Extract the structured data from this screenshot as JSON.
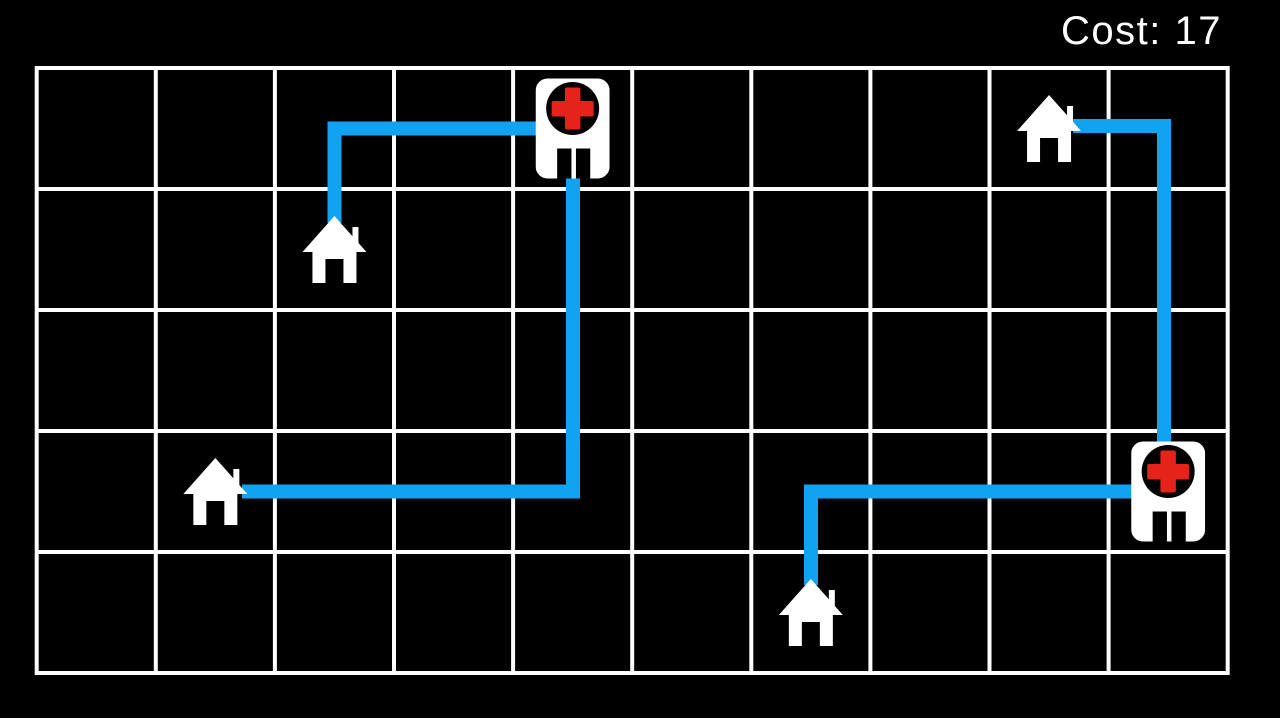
{
  "hud": {
    "cost_label": "Cost:",
    "cost_value": "17",
    "cost_text": "Cost: 17"
  },
  "colors": {
    "background": "#000000",
    "grid_line": "#ffffff",
    "route": "#11a2f2",
    "icon": "#ffffff",
    "icon_detail": "#000000",
    "cross_red": "#e4231a",
    "hud_text": "#ffffff"
  },
  "board": {
    "columns": 10,
    "rows": 5,
    "origin_x": 36.7,
    "origin_y": 68,
    "cell_width": 119.1,
    "cell_height": 121,
    "grid_line_width": 4
  },
  "icon_sizes": {
    "house": {
      "width": 64,
      "height": 67
    },
    "hospital": {
      "width": 74,
      "height": 100
    }
  },
  "entities": [
    {
      "id": "hospital-1",
      "type": "hospital",
      "icon": "hospital-icon",
      "col": 4,
      "row": 0
    },
    {
      "id": "hospital-2",
      "type": "hospital",
      "icon": "hospital-icon",
      "col": 9,
      "row": 3
    },
    {
      "id": "house-1",
      "type": "house",
      "icon": "house-icon",
      "col": 2,
      "row": 1
    },
    {
      "id": "house-2",
      "type": "house",
      "icon": "house-icon",
      "col": 1,
      "row": 3
    },
    {
      "id": "house-3",
      "type": "house",
      "icon": "house-icon",
      "col": 8,
      "row": 0
    },
    {
      "id": "house-4",
      "type": "house",
      "icon": "house-icon",
      "col": 6,
      "row": 4
    }
  ],
  "routes": [
    {
      "id": "route-1",
      "from": "hospital-1",
      "to": "house-1",
      "points": [
        [
          573,
          128.5
        ],
        [
          334.5,
          128.5
        ],
        [
          334.5,
          223
        ]
      ]
    },
    {
      "id": "route-2",
      "from": "hospital-1",
      "to": "house-2",
      "points": [
        [
          573,
          128.5
        ],
        [
          573,
          491.5
        ],
        [
          242,
          491.5
        ]
      ]
    },
    {
      "id": "route-3",
      "from": "house-3",
      "to": "hospital-2",
      "points": [
        [
          1073,
          126
        ],
        [
          1164,
          126
        ],
        [
          1164,
          491.5
        ]
      ]
    },
    {
      "id": "route-4",
      "from": "hospital-2",
      "to": "house-4",
      "points": [
        [
          1168,
          491.5
        ],
        [
          811,
          491.5
        ],
        [
          811,
          585
        ]
      ]
    }
  ],
  "route_style": {
    "stroke_width": 14
  }
}
